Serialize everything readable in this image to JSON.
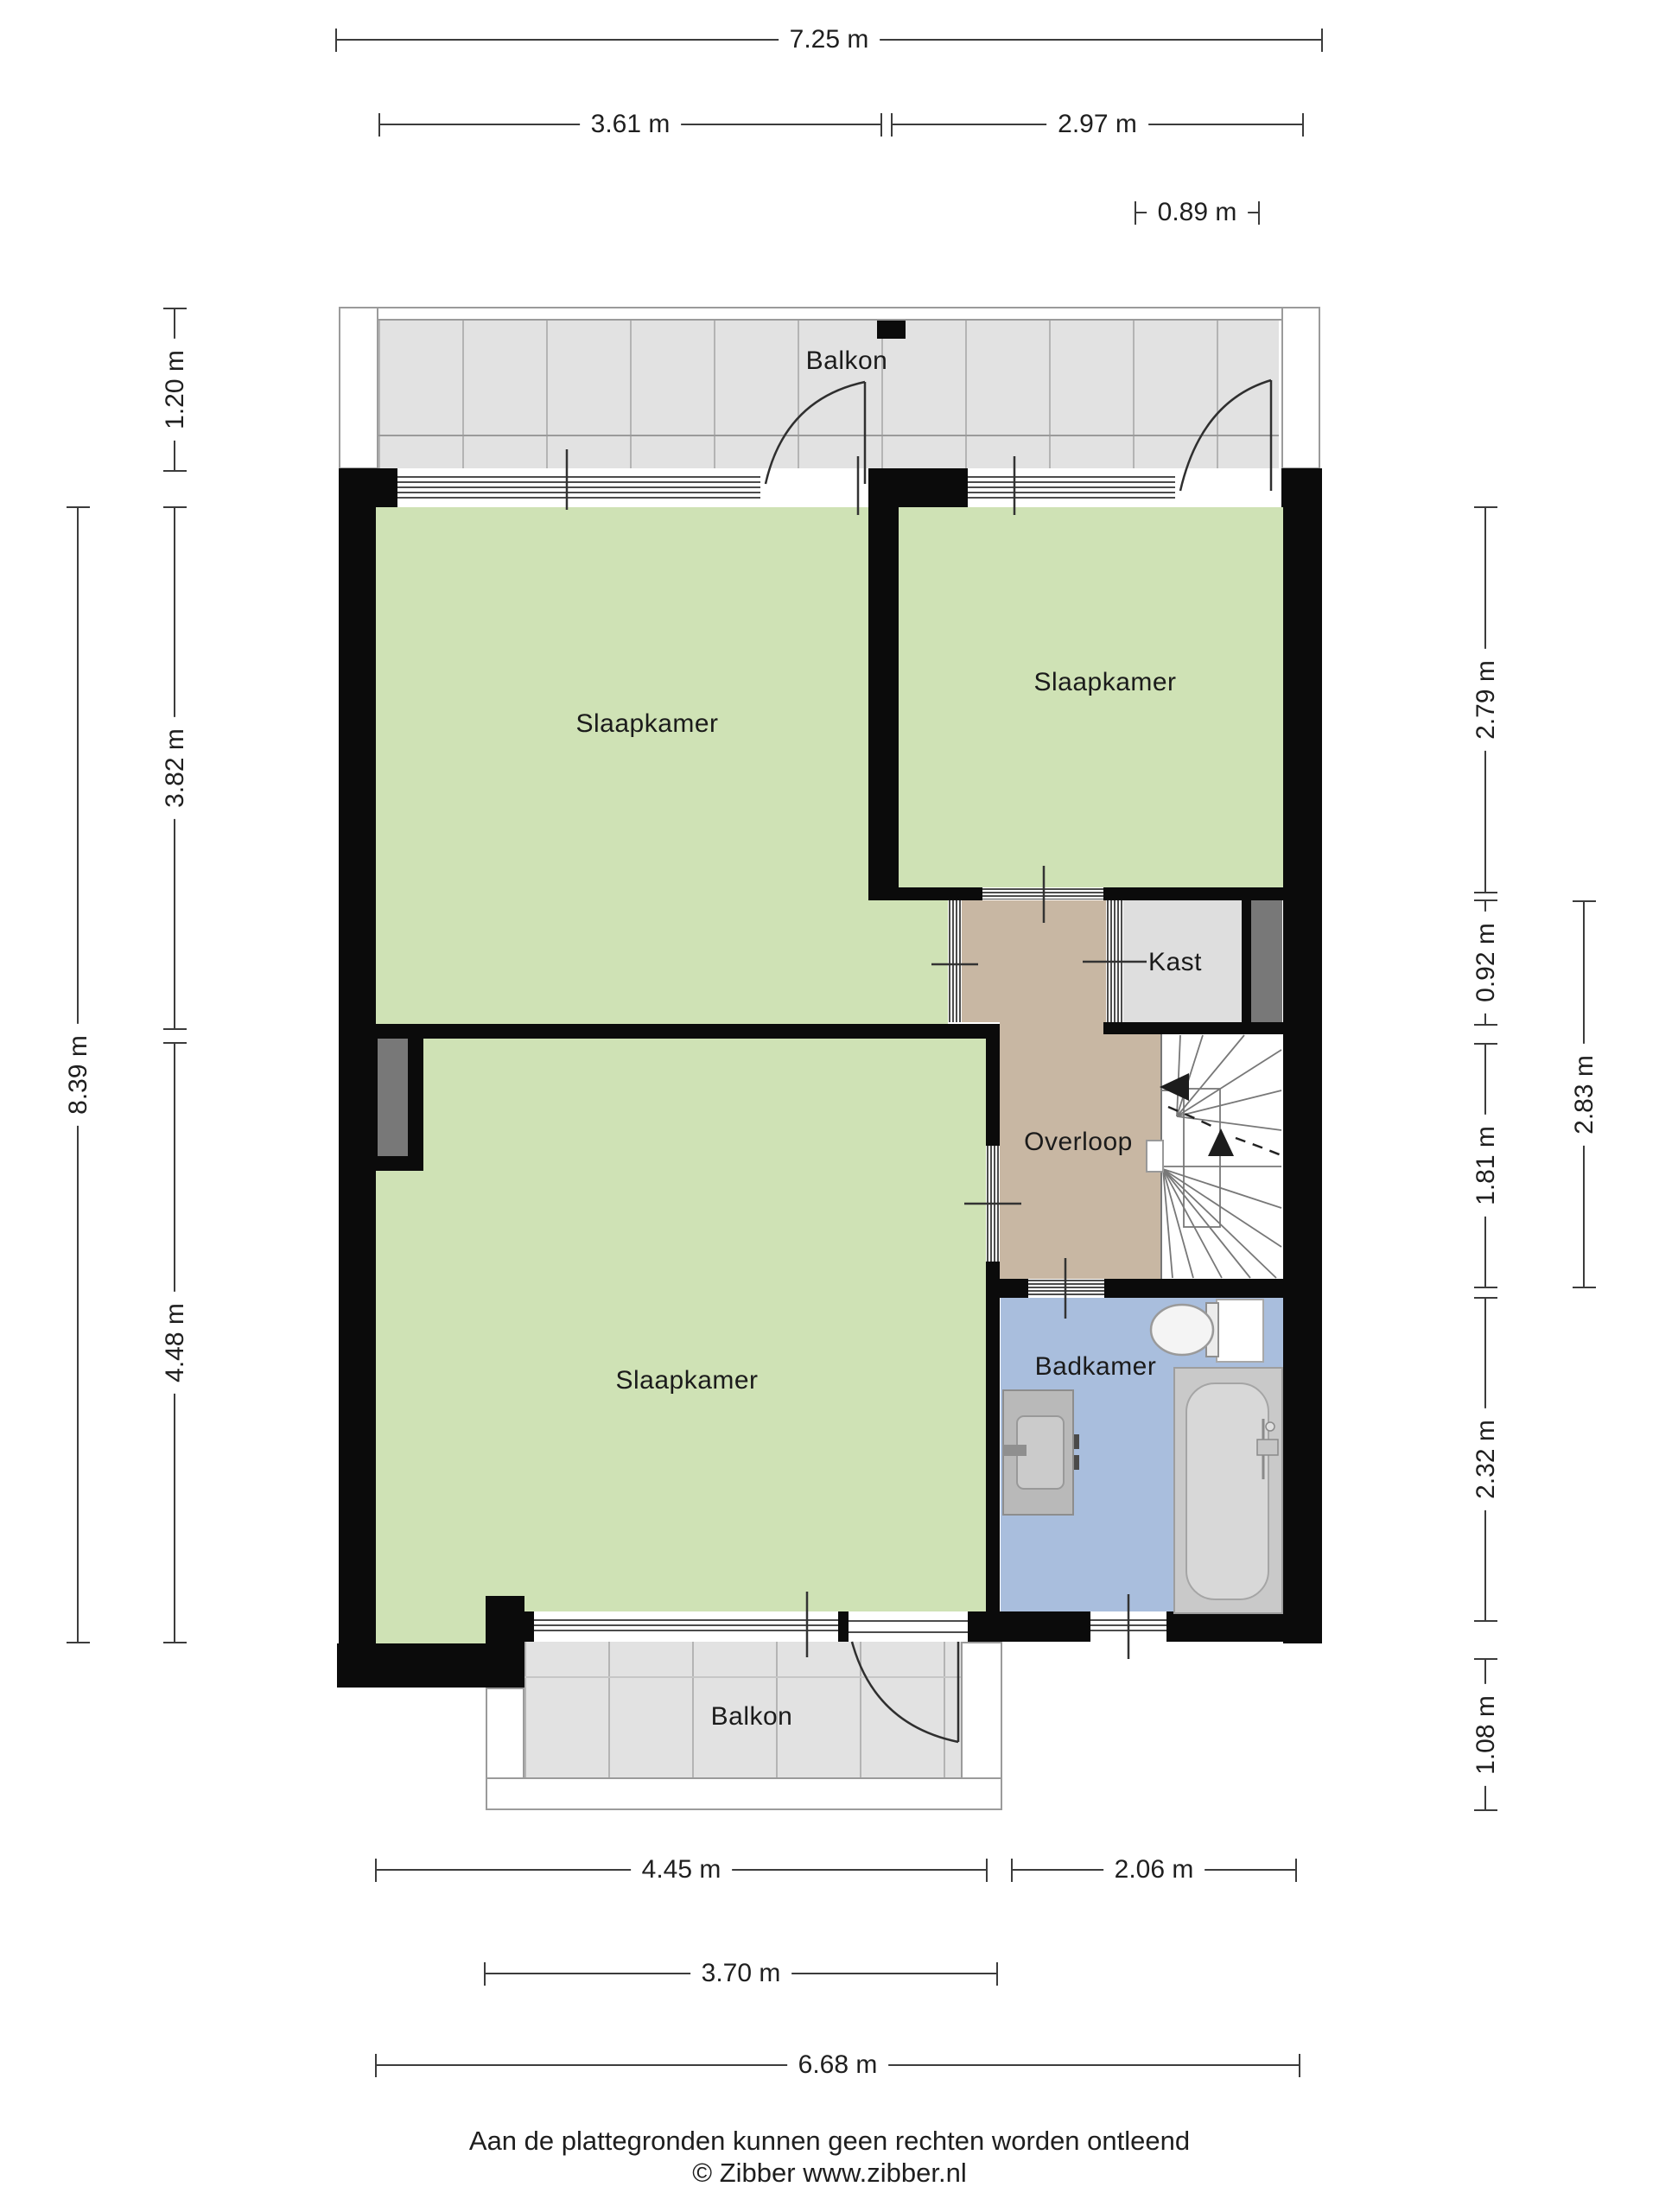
{
  "theme": {
    "wall": "#0b0b0b",
    "room-green": "#cfe2b5",
    "hall": "#c8b7a3",
    "closet": "#dedede",
    "bath": "#a9bedd",
    "balcony": "#e2e2e2",
    "duct": "#787878",
    "ink": "#3c3c3c"
  },
  "rooms": {
    "balkon_top": {
      "label": "Balkon"
    },
    "slaapkamer_left": {
      "label": "Slaapkamer"
    },
    "slaapkamer_right": {
      "label": "Slaapkamer"
    },
    "kast": {
      "label": "Kast"
    },
    "overloop": {
      "label": "Overloop"
    },
    "slaapkamer_bottom": {
      "label": "Slaapkamer"
    },
    "badkamer": {
      "label": "Badkamer"
    },
    "balkon_bottom": {
      "label": "Balkon"
    }
  },
  "dimensions": {
    "top": [
      {
        "label": "7.25 m"
      },
      {
        "label": "3.61 m"
      },
      {
        "label": "2.97 m"
      },
      {
        "label": "0.89 m"
      }
    ],
    "bottom": [
      {
        "label": "4.45 m"
      },
      {
        "label": "2.06 m"
      },
      {
        "label": "3.70 m"
      },
      {
        "label": "6.68 m"
      }
    ],
    "left": [
      {
        "label": "1.20 m"
      },
      {
        "label": "3.82 m"
      },
      {
        "label": "4.48 m"
      },
      {
        "label": "8.39 m"
      }
    ],
    "right": [
      {
        "label": "2.79 m"
      },
      {
        "label": "0.92 m"
      },
      {
        "label": "1.81 m"
      },
      {
        "label": "2.32 m"
      },
      {
        "label": "1.08 m"
      },
      {
        "label": "2.83 m"
      }
    ]
  },
  "footer": {
    "disclaimer": "Aan de plattegronden kunnen geen rechten worden ontleend",
    "credit": "© Zibber www.zibber.nl"
  }
}
